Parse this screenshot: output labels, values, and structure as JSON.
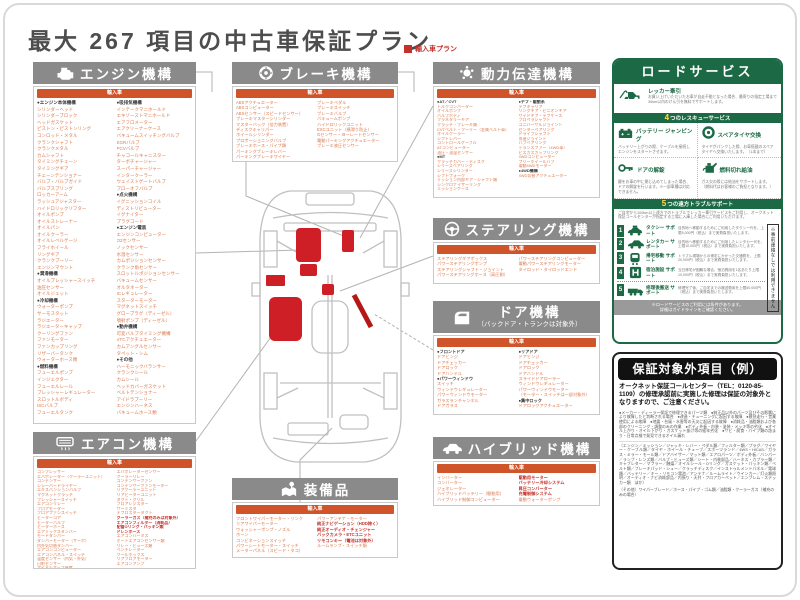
{
  "page": {
    "title": "最大 267 項目の中古車保証プラン",
    "legend": "輸入車プラン"
  },
  "colors": {
    "accent_orange": "#D0542A",
    "item_orange": "#DC7A4E",
    "header_gray": "#8A8A8A",
    "service_green": "#1C6A45",
    "highlight_red": "#CF1F26",
    "title_gray": "#4D4D4D",
    "legend_red": "#C5302A"
  },
  "sections": {
    "engine": {
      "title": "エンジン機構",
      "tag": "輸入車",
      "columns": [
        [
          "●エンジン本体機構",
          "シリンダーヘッド",
          "シリンダーブロック",
          "ヘッドガスケット",
          "ピストン・ピストンリング",
          "コンロッド・メタル",
          "クランクシャフト",
          "クランクメタル",
          "カムシャフト",
          "タイミングチェーン",
          "タイミングギア",
          "チェーンテンショナー",
          "バルブ・バルブガイド",
          "バルブスプリング",
          "ロッカーアーム",
          "ラッシュアジャスター",
          "ハイドロリックリフター",
          "オイルポンプ",
          "オイルストレーナー",
          "オイルパン",
          "オイルクーラー",
          "オイルレベルゲージ",
          "フライホイール",
          "リングギア",
          "クランクプーリー",
          "エンジンマウント",
          "●潤滑機構",
          "オイルプレッシャースイッチ",
          "油圧センサー",
          "オイルジェット",
          "●冷却機構",
          "ウォーターポンプ",
          "サーモスタット",
          "ラジエーター",
          "ラジエーターキャップ",
          "クーリングファン",
          "ファンモーター",
          "ファンカップリング",
          "リザーバータンク",
          "ウォーターホース類",
          "●燃料機構",
          "フューエルポンプ",
          "インジェクター",
          "フューエルレール",
          "プレッシャーレギュレーター",
          "スロットルボディ",
          "ISCバルブ",
          "フューエルタンク"
        ],
        [
          "●吸排気機構",
          "インテークマニホールド",
          "エキゾーストマニホールド",
          "エアフロメーター",
          "エアクリーナーケース",
          "バキュームスイッチングバルブ",
          "EGRバルブ",
          "PCVバルブ",
          "チャコールキャニスター",
          "ターボチャージャー",
          "スーパーチャージャー",
          "インタークーラー",
          "ウェイストゲートバルブ",
          "ブローオフバルブ",
          "●点火機構",
          "イグニッションコイル",
          "ディストリビューター",
          "イグナイター",
          "プラグコード",
          "●エンジン電装",
          "エンジンコンピューター",
          "O2センサー",
          "ノックセンサー",
          "水温センサー",
          "カムポジションセンサー",
          "クランク角センサー",
          "スロットルポジションセンサー",
          "バキュームセンサー",
          "オルタネーター",
          "ICレギュレーター",
          "スターターモーター",
          "マグネットスイッチ",
          "グロープラグ（ディーゼル）",
          "噴射ポンプ（ディーゼル）",
          "●動弁機構",
          "可変バルブタイミング機構",
          "VTCアクチュエーター",
          "カムアングルセンサー",
          "タペット・シム",
          "●その他",
          "ハーモニックバランサー",
          "クランクシール",
          "カムシール",
          "ヘッドカバーガスケット",
          "ベルトテンショナー",
          "アイドラプーリー",
          "エンジンハーネス",
          "バキュームホース類"
        ]
      ]
    },
    "brake": {
      "title": "ブレーキ機構",
      "tag": "輸入車",
      "columns": [
        [
          "ABSアクチュエーター",
          "ABSコンピューター",
          "ABSセンサー（スピードセンサー）",
          "ブレーキマスターシリンダー",
          "マスターバック（倍力装置）",
          "ディスクキャリパー",
          "ホイールシリンダー",
          "プロポーショニングバルブ",
          "ブレーキホース・パイプ類",
          "パーキングブレーキレバー",
          "パーキングブレーキワイヤー"
        ],
        [
          "ブレーキペダル",
          "ブレーキスイッチ",
          "ブレーキバルブ",
          "バキュームポンプ",
          "ハイドロリックユニット",
          "ESCユニット（横滑り防止）",
          "Gセンサー・ヨーレートセンサー",
          "電動パーキングアクチュエーター",
          "ブレーキ液圧センサー"
        ]
      ]
    },
    "power": {
      "title": "動力伝達機構",
      "tag": "輸入車",
      "columns": [
        [
          "●AT／CVT",
          "トルクコンバーター",
          "オイルポンプ",
          "バルブボディ",
          "プラネタリーギア",
          "クラッチ・ブレーキ類",
          "CVTベルト・プーリー（金属ベルト車）",
          "オイルクーラー",
          "シフトレバー",
          "コントロールケーブル",
          "ATコンピューター",
          "油圧・油温センサー",
          "●MT",
          "クラッチカバー・ディスク",
          "レリーズベアリング",
          "レリーズシリンダー",
          "シフトフォーク",
          "ミッション内部ギア・シャフト類",
          "シンクロナイザーリング",
          "ミッションケース"
        ],
        [
          "●デフ・駆動系",
          "デフキャリア",
          "リングギア・ピニオンギア",
          "サイドギア・デフケース",
          "プロペラシャフト",
          "ユニバーサルジョイント",
          "センターベアリング",
          "ドライブシャフト",
          "等速ジョイント",
          "ハブベアリング",
          "トランスファー（4WD車）",
          "ビスカスカップリング",
          "4WDコンピューター",
          "フリーホイールハブ",
          "電動4WDモーター",
          "●4WD機構",
          "4WD切替アクチュエーター"
        ]
      ]
    },
    "steering": {
      "title": "ステアリング機構",
      "tag": "輸入車",
      "columns": [
        [
          "ステアリングギアボックス",
          "パワーステアリングポンプ",
          "ステアリングシャフト・ジョイント",
          "パワーステアリングホース（高圧側）"
        ],
        [
          "パワーステアリングコンピューター",
          "電動パワーステアリングモーター",
          "タイロッド・タイロッドエンド"
        ]
      ]
    },
    "door": {
      "title": "ドア機構",
      "subtitle": "（バックドア・トランクは対象外）",
      "tag": "輸入車",
      "columns": [
        [
          "●フロントドア",
          "ドアヒンジ",
          "ドアチェッカー",
          "ドアロック",
          "ドアハンドル",
          "●パワーウィンドウ",
          "スイッチ",
          "ウィンドウレギュレーター",
          "パワーウィンドウモーター",
          "ガラスランチャンネル",
          "ドアガラス"
        ],
        [
          "●リアドア",
          "ドアヒンジ",
          "ドアチェッカー",
          "ドアロック",
          "ドアハンドル",
          "スライドドアローラー",
          "ウィンドウレギュレーター",
          "パワーウィンドウモーター",
          "（モーター・スイッチは一部対象外）",
          "●集中ロック",
          "ドアロックアクチュエーター"
        ]
      ]
    },
    "ac": {
      "title": "エアコン機構",
      "tag": "輸入車",
      "columns": [
        [
          "コンプレッサー",
          "エバポレーター（クーラーユニット）",
          "コンデンサー",
          "レシーバードライヤー",
          "エキスパンションバルブ",
          "マグネットクラッチ",
          "プレッシャースイッチ",
          "エアコンリレー",
          "ブロアモーター",
          "ブロアファンスイッチ",
          "ヒーターコア",
          "ヒーターバルブ",
          "ヒーターホース",
          "エアミックスダンパー",
          "モードダンパー",
          "ダンパーモーター（サーボ）",
          "内外気切替ダンパー",
          "エアコンコンピューター",
          "エアコンパネル・スイッチ",
          "温度センサー（内気・外気）",
          "日射センサー",
          "アイドルアップ装置"
        ],
        [
          "エバポレーターセンサー",
          "クーラーリレー",
          "コンデンサーファン",
          "コンデンサーファンモーター",
          "リアクーラーユニット",
          "リアヒーターユニット",
          "ダクト・グリル",
          "ブロアレジスター",
          "サーミスタ",
          "デフロスターダクト",
          "■クーラーガス（補充のみは対象外）",
          "■エアコンフィルター（消耗品）",
          "■配管Oリング・パッキン類",
          "■ドレンホース",
          "エアコンハーネス",
          "オートエアコンセンサー類",
          "リレー・ヒューズ類",
          "ベンチレーター",
          "クールボックス",
          "リアブロアモーター",
          "エアコンアンプ"
        ]
      ]
    },
    "equipment": {
      "title": "装備品",
      "tag": "輸入車",
      "columns": [
        [
          "フロントワイパーモーター・リンク",
          "リアワイパーモーター",
          "ウォッシャーポンプ・ノズル",
          "ホーン",
          "コンビネーションスイッチ",
          "パワーシートモーター・スイッチ",
          "メーターパネル（スピード・タコ）"
        ],
        [
          "パワーアンテナ・モーター",
          "■純正ナビゲーション（HDD除く）",
          "■純正オーディオ・チェンジャー",
          "■バックカメラ・ETCユニット",
          "■リモコンキー（電池は対象外）",
          "ルームランプ・スイッチ類"
        ]
      ]
    },
    "hybrid": {
      "title": "ハイブリッド機構",
      "tag": "輸入車",
      "columns": [
        [
          "インバーター",
          "コンバーター",
          "ジェネレーター",
          "ハイブリッドバッテリー（駆動用）",
          "ハイブリッド制御コンピューター"
        ],
        [
          "■駆動用モーター",
          "■バッテリー冷却システム",
          "■昇圧コンバーター",
          "■充電制御システム",
          "電動ウォーターポンプ"
        ]
      ]
    }
  },
  "roadservice": {
    "title": "ロードサービス",
    "tow": {
      "label": "レッカー牽引",
      "desc": "お買い上げいただいたお車が自走不能となった場合、最寄りの指定工場まで30km以内のけん引を無料でサポートします。"
    },
    "rescue": {
      "num": "4",
      "bar": "つのレスキューサービス",
      "items": [
        {
          "label": "バッテリー ジャンピング",
          "desc": "バッテリー上がりの際、ケーブルを接続しエンジンをスタートさせます。"
        },
        {
          "label": "スペアタイヤ交換",
          "desc": "タイヤがパンクした際、お車搭載のスペアタイヤへ交換いたします。（1本まで）"
        },
        {
          "label": "ドアの解錠",
          "desc": "鍵をお車の中に閉じ込めてしまった場合、ドアの解錠を行います。※一部車種は対応できません。"
        },
        {
          "label": "燃料切れ給油",
          "desc": "ガス欠の際には給油をサポートします。（燃料代はお客様のご負担となります。）"
        }
      ]
    },
    "support": {
      "num": "5",
      "bar": "つの遠方トラブルサポート",
      "intro": "ご自宅から100km以上遠方でのトラブルでレッカー牽引サービスをご利用し、オークネット保証コールセンターが指定する工場に入庫した場合にご利用いただけます。",
      "rows": [
        {
          "num": "1",
          "label": "タクシー サポート",
          "desc": "目的地へ移動するためにご利用したタクシー代を、上限5,000円（税込）まで実費負担いたします。"
        },
        {
          "num": "2",
          "label": "レンタカー サポート",
          "desc": "目的地へ移動するためにご利用したレンタカー代を、上限10,000円（税込）まで実費負担いたします。"
        },
        {
          "num": "3",
          "label": "帰宅移動 サポート",
          "desc": "トラブル現場からの帰宅にかかった交通費を、上限20,000円（税込）まで実費負担いたします。"
        },
        {
          "num": "4",
          "label": "宿泊施設 サポート",
          "desc": "当日帰宅が困難な場合、宿泊費用を1名あたり上限10,000円（税込）まで実費負担いたします。"
        },
        {
          "num": "5",
          "label": "修理後搬送 サポート",
          "desc": "修理完了後、ご自宅までの搬送費用を上限50,000円（税込）まで実費負担いたします。"
        }
      ],
      "side_note": "※事前連絡なしでは利用できません"
    },
    "footer1": "※ロードサービスのご利用には条件があります。",
    "footer2": "詳細はガイドラインをご確認ください。"
  },
  "exclusions": {
    "title": "保証対象外項目（例）",
    "intro": "オークネット保証コールセンター（TEL：0120-85-1109）の修理承認前に実施した修理は保証の対象外となりますので、ご注意ください。",
    "bullets": "●メーカー・ディーラー保証で修理できるパーツ類　●純正品以外のパーツ及びその影響により故障したと判断される場合　●改造・チューニングに起因する故障　●競技走行・営業使用による故障　●地震・台風・水害等の天災に起因する故障　●消耗品・油脂類および各部のクリーニング・調整のみの作業　●ボディ外板・内装・塗装・メッキ等の劣化　●オイル上がり・オイル下がり・ガスケット抜け等の経年劣化　●サビ・腐食・パイプ類の詰まり・日常点検で発見できるオイル漏れ",
    "fine_print": "（エンジン／ミッション／ジャッキ・レバー・ペダル類／フィルター類／プラグ／ワイヤー・ケーブル類／タイヤ・ホイール・チューブ／スポーツランド／4WS・HICAS／ガラス・ミラー・モール類／ドアバイザー／マット類／エアロパーツ／ボディ外板／バンパー／ランプ・レンズ類／バルブ・ヒューズ類／シート・内装部品／ハーネス・カプラー類／キャブレター／マフラー／触媒／オイルシール・Oリング／ガスケット・パッキン類／ベルト類／ブレーキパッド・シュー／クラッチディスク／インストゥルメントパネル／電球類／バッテリー／キー・リモコン電池／アンテナ／ルームライト／ウインカー／灯火類照明／オーディオ・ナビ消耗部品／内張り・天井・フロアカーペット／エンブレム・ステッカー類　ほか）",
    "last": "（その他）ワイパーブレード／ホース・パイプ・ゴム類／油脂類・クーラーガス（補充のみの場合）"
  }
}
